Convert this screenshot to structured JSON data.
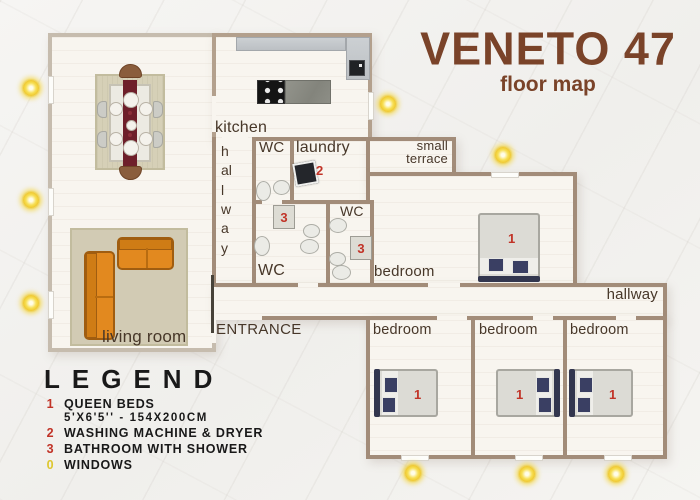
{
  "title": {
    "name": "VENETO 47",
    "subtitle": "floor map"
  },
  "rooms": {
    "kitchen": "kitchen",
    "hallway": "hallway",
    "wc": "WC",
    "laundry": "laundry",
    "terrace_line1": "small",
    "terrace_line2": "terrace",
    "bedroom": "bedroom",
    "living_room": "living room",
    "entrance": "ENTRANCE"
  },
  "markers": {
    "queen_bed": "1",
    "washer": "2",
    "bathroom": "3"
  },
  "legend": {
    "title": "LEGEND",
    "items": [
      {
        "num": "1",
        "label": "QUEEN BEDS",
        "sublabel": "5'X6'5'' - 154X200CM"
      },
      {
        "num": "2",
        "label": "WASHING MACHINE & DRYER"
      },
      {
        "num": "3",
        "label": "BATHROOM WITH SHOWER"
      },
      {
        "num": "0",
        "label": "WINDOWS"
      }
    ]
  },
  "colors": {
    "wall": "#a28c79",
    "wall_light": "#c6bcae",
    "floor": "#f8f5ef",
    "title_brown": "#7a4329",
    "label_dark": "#473729",
    "marker_red": "#c13327",
    "window_yellow": "#f0ce3c",
    "sofa_orange": "#e2891f",
    "runner_maroon": "#6e1f2a",
    "pillow_navy": "#3a3f63",
    "rug_beige": "#d6d0b7"
  }
}
